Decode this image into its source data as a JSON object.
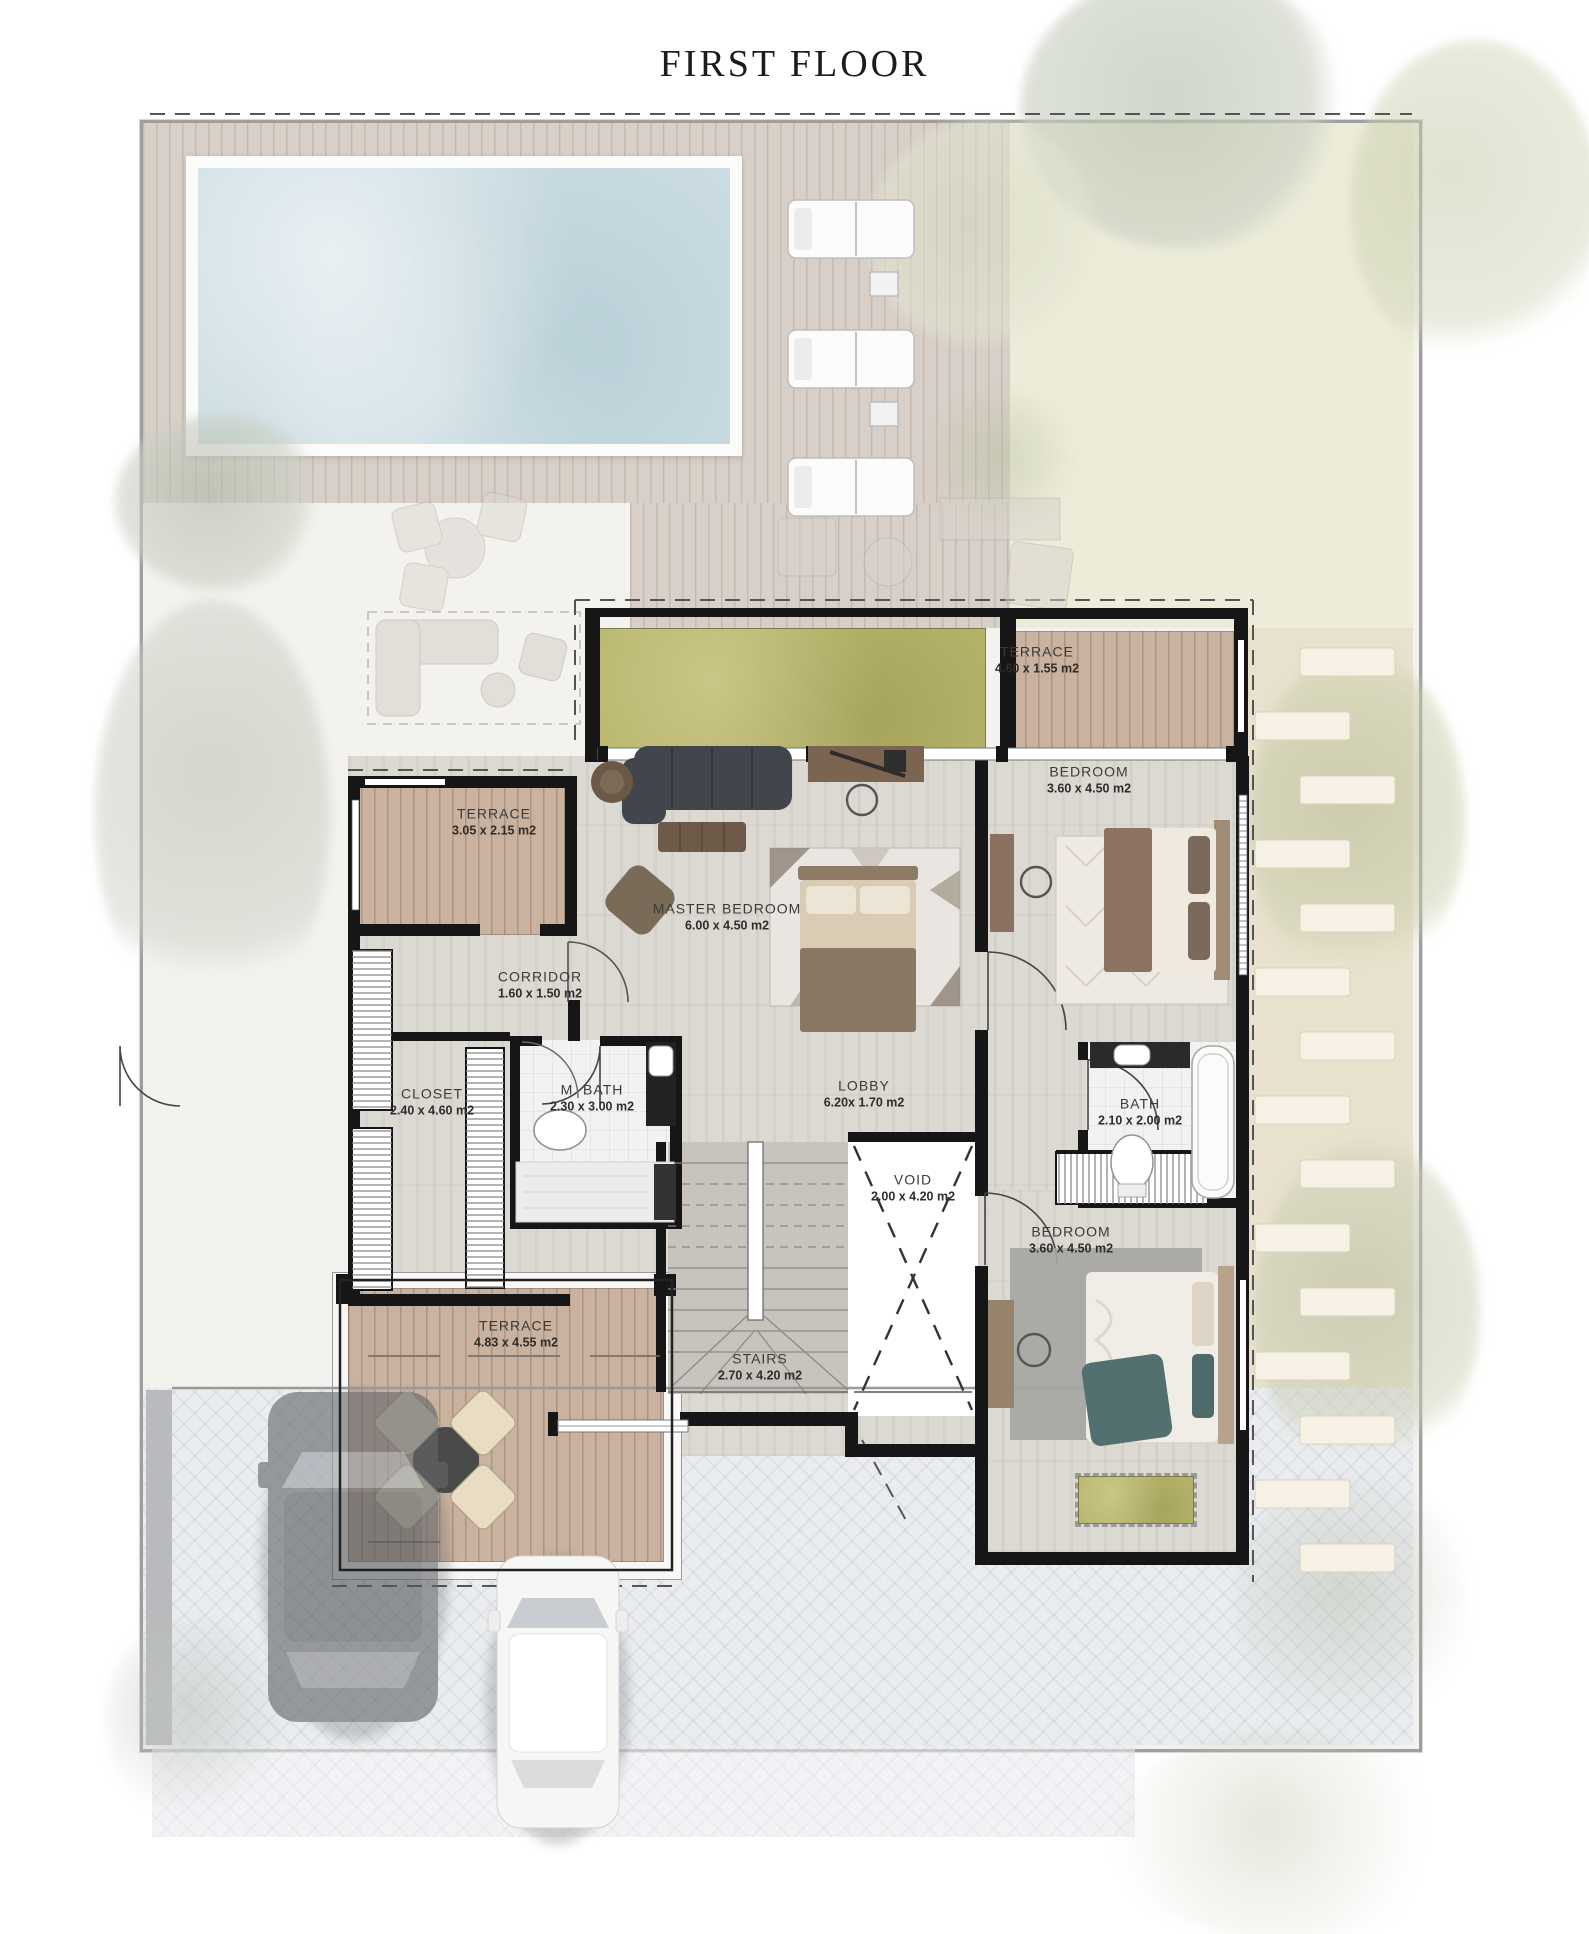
{
  "title": "FIRST FLOOR",
  "rooms": {
    "terrace_top": {
      "name": "TERRACE",
      "dims": "4.60 x 1.55 m2"
    },
    "bedroom_top": {
      "name": "BEDROOM",
      "dims": "3.60 x 4.50 m2"
    },
    "terrace_left": {
      "name": "TERRACE",
      "dims": "3.05 x 2.15 m2"
    },
    "master_bedroom": {
      "name": "MASTER BEDROOM",
      "dims": "6.00 x 4.50 m2"
    },
    "corridor": {
      "name": "CORRIDOR",
      "dims": "1.60 x 1.50 m2"
    },
    "closet": {
      "name": "CLOSET",
      "dims": "2.40 x 4.60 m2"
    },
    "m_bath": {
      "name": "M. BATH",
      "dims": "2.30 x 3.00 m2"
    },
    "lobby": {
      "name": "LOBBY",
      "dims": "6.20x 1.70 m2"
    },
    "bath": {
      "name": "BATH",
      "dims": "2.10 x 2.00 m2"
    },
    "void": {
      "name": "VOID",
      "dims": "2.00 x 4.20 m2"
    },
    "bedroom_bottom": {
      "name": "BEDROOM",
      "dims": "3.60 x 4.50 m2"
    },
    "terrace_bottom": {
      "name": "TERRACE",
      "dims": "4.83 x 4.55 m2"
    },
    "stairs": {
      "name": "STAIRS",
      "dims": "2.70 x 4.20 m2"
    }
  },
  "colors": {
    "wall": "#161616",
    "pool_water": "#ccdde3",
    "grass": "#b7b46a",
    "deck_wood": "#d8d0c8",
    "terrace_wood": "#c9b2a0",
    "floor": "#dcd8d2",
    "garden": "#edecd9",
    "stone_path": "#e8e1cd",
    "driveway": "#eaecef"
  }
}
